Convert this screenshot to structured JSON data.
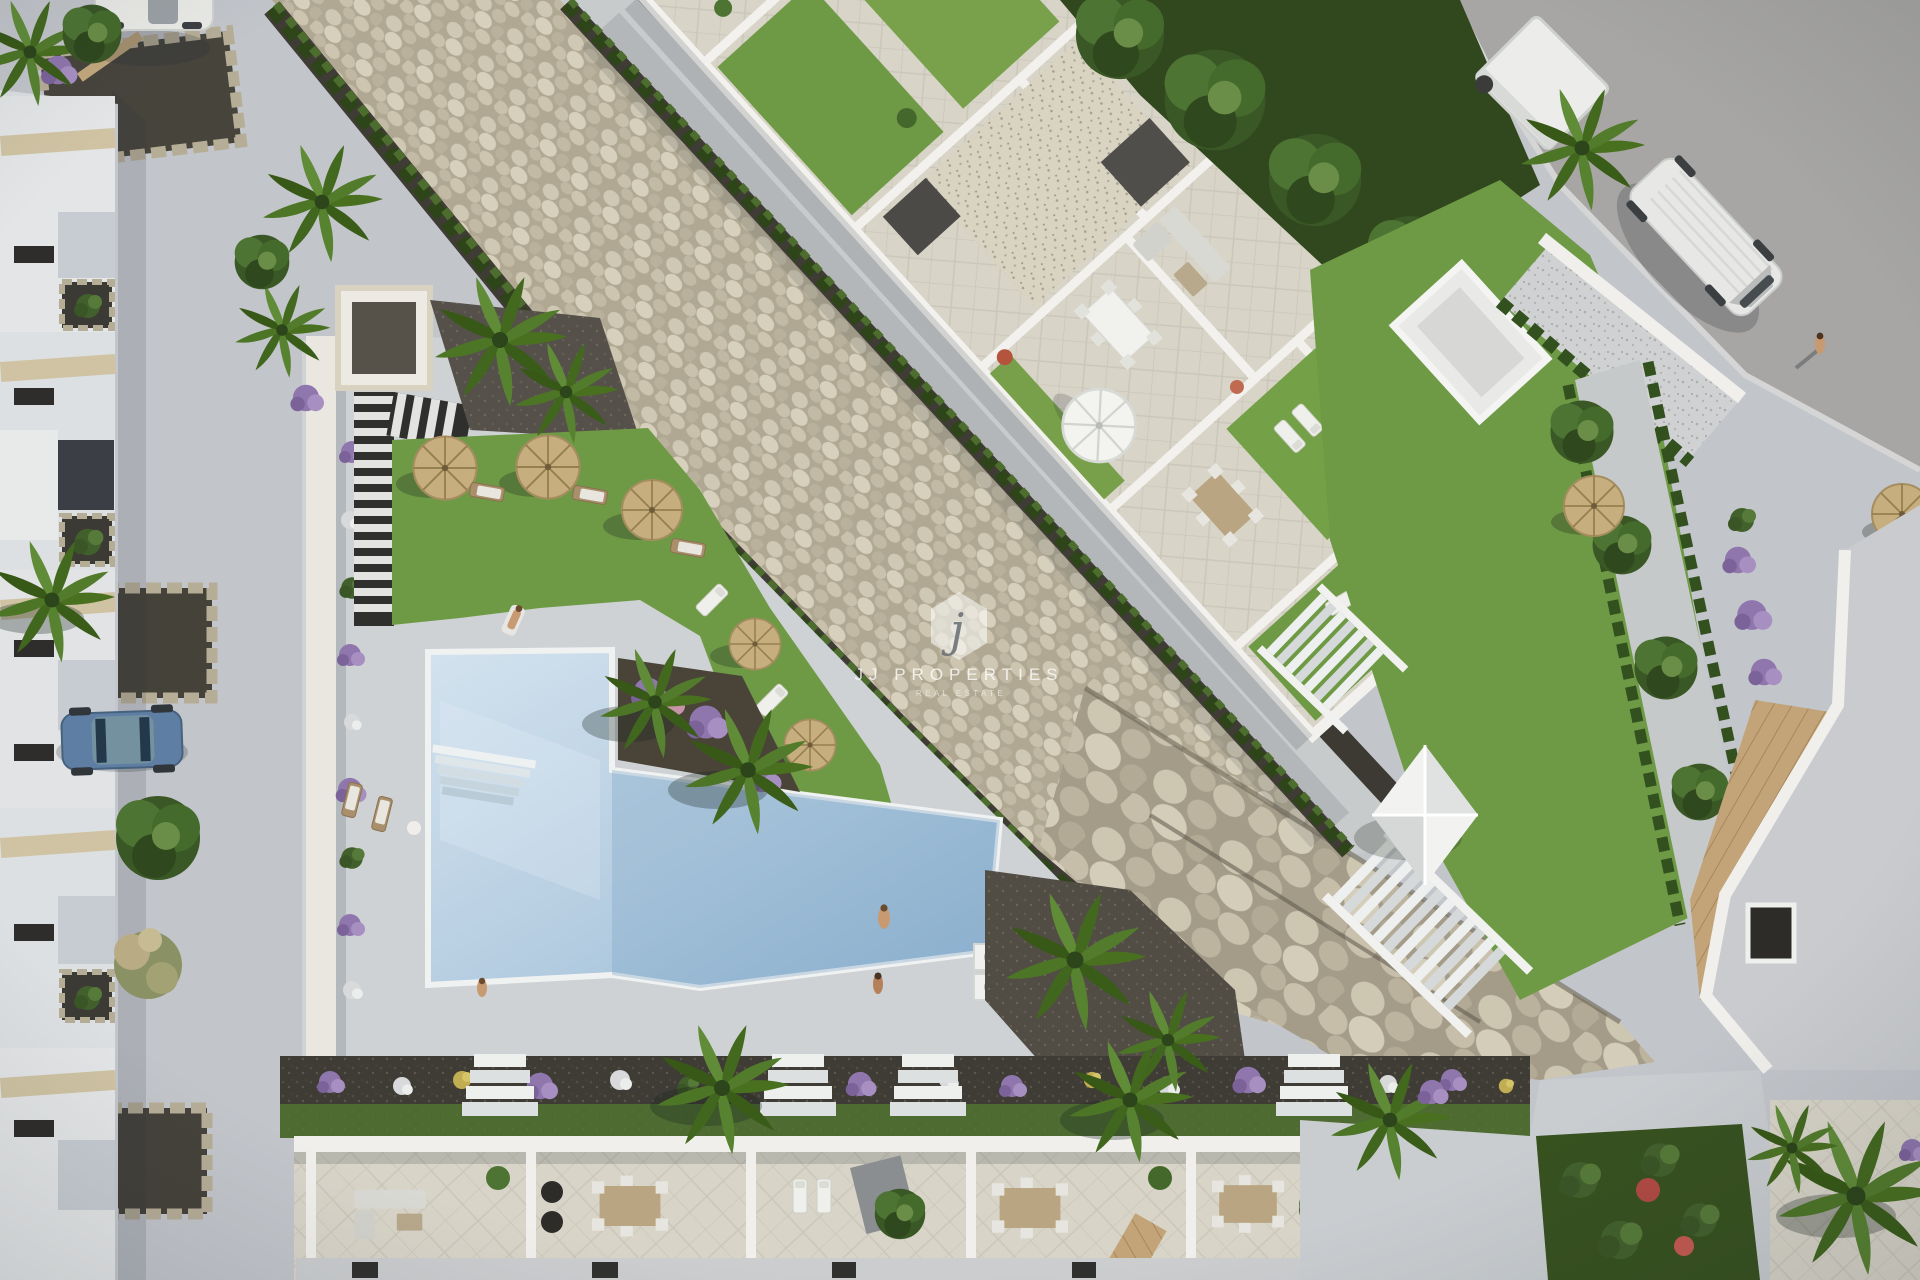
{
  "watermark": {
    "monogram": "j",
    "title": "JJ PROPERTIES",
    "subtitle": "REAL ESTATE"
  },
  "palette": {
    "road": "#c2c5ca",
    "deck": "#ced2d5",
    "asphalt": "#a7a6a4",
    "lawn": "#6f9a45",
    "hedge": "#33501f",
    "soil": "#3f3c35",
    "wall": "#f0efeb",
    "paver": "#d8d4c8",
    "pebbleBase": "#b6ae98",
    "waterLight": "#cfe0ec",
    "waterDeep": "#93b7d4",
    "wood": "#c3a478",
    "umbrellaStraw": "#c6ae7e",
    "flowerPurple": "#9b82b8",
    "flowerWhite": "#dfe0e1",
    "flowerYellow": "#c6b253",
    "flowerPink": "#c794a9",
    "carBlue": "#5e7ea3",
    "vehicleWhite": "#e9eae7"
  }
}
